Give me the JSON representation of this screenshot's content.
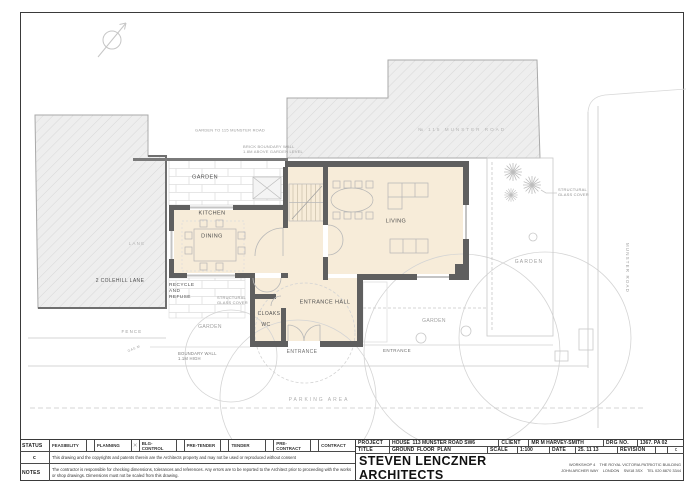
{
  "plan": {
    "room_labels": {
      "kitchen": "KITCHEN",
      "dining": "DINING",
      "living": "LIVING",
      "entrance_hall": "ENTRANCE HALL",
      "cloaks": "CLOAKS",
      "wc": "WC",
      "recycle": "RECYCLE\nAND\nREFUSE",
      "entrance_left": "ENTRANCE",
      "entrance_right": "ENTRANCE"
    },
    "site_labels": {
      "garden_top": "GARDEN",
      "garden_right": "GARDEN",
      "garden_lower_left": "GARDEN",
      "garden_lower_mid": "GARDEN",
      "garden_to_115": "GARDEN TO 115 MUNSTER ROAD",
      "no_115": "№  115  MUNSTER  ROAD",
      "brick_wall": "BRICK BOUNDARY WALL\n1.8M ABOVE GARDEN LEVEL",
      "colehill": "2 COLEHILL LANE",
      "lane": "LANE",
      "fence": "FENCE",
      "gas": "GAS M",
      "boundary_wall": "BOUNDARY WALL\n1.1M HIGH",
      "parking": "PARKING  AREA",
      "munster_road": "MUNSTER ROAD",
      "struct_glass_left": "STRUCTURAL\nGLASS COVER",
      "struct_glass_right": "STRUCTURAL\nGLASS COVER"
    }
  },
  "title_block": {
    "status_label": "STATUS",
    "revision_letter": "c",
    "notes_label": "NOTES",
    "status_items": [
      {
        "label": "FEASIBILITY",
        "mark": ""
      },
      {
        "label": "PLANNING",
        "mark": "✕"
      },
      {
        "label": "BLG-CONTROL",
        "mark": ""
      },
      {
        "label": "PRE-TENDER",
        "mark": ""
      },
      {
        "label": "TENDER",
        "mark": ""
      },
      {
        "label": "PRE-CONTRACT",
        "mark": ""
      },
      {
        "label": "CONTRACT",
        "mark": ""
      }
    ],
    "copyright": "This drawing and the copyrights and patents therein are the Architects property and may not be used or reproduced without consent",
    "notes": "The contractor is responsible for checking dimensions, tolerances and references. Any errors are to be reported to the Architect prior to proceeding with the works or shop drawings. Dimensions must not be scaled from this drawing.",
    "project_label": "PROJECT",
    "project": "HOUSE  113 MUNSTER ROAD SW6",
    "client_label": "CLIENT",
    "client": "MR M HARVEY-SMITH",
    "drg_no_label": "DRG NO.",
    "drg_no": "1367. PA 02",
    "title_label": "TITLE",
    "title": "GROUND  FLOOR  PLAN",
    "scale_label": "SCALE",
    "scale": "1:100",
    "date_label": "DATE",
    "date": "25. 11 13",
    "revision_label": "REVISION",
    "revision": "c",
    "firm": "STEVEN LENCZNER ARCHITECTS",
    "address_line1": "WORKSHOP 4    THE ROYAL VICTORIA PATRIOTIC BUILDING",
    "address_line2": "JOHN ARCHER WAY    LONDON    SW18 3SX    TEL 020 8870 3344"
  },
  "colors": {
    "wall": "#5f5f5f",
    "room_fill": "#f7ecd9",
    "hatch_fill": "#eeeeee",
    "linework": "#c9c9c9"
  }
}
